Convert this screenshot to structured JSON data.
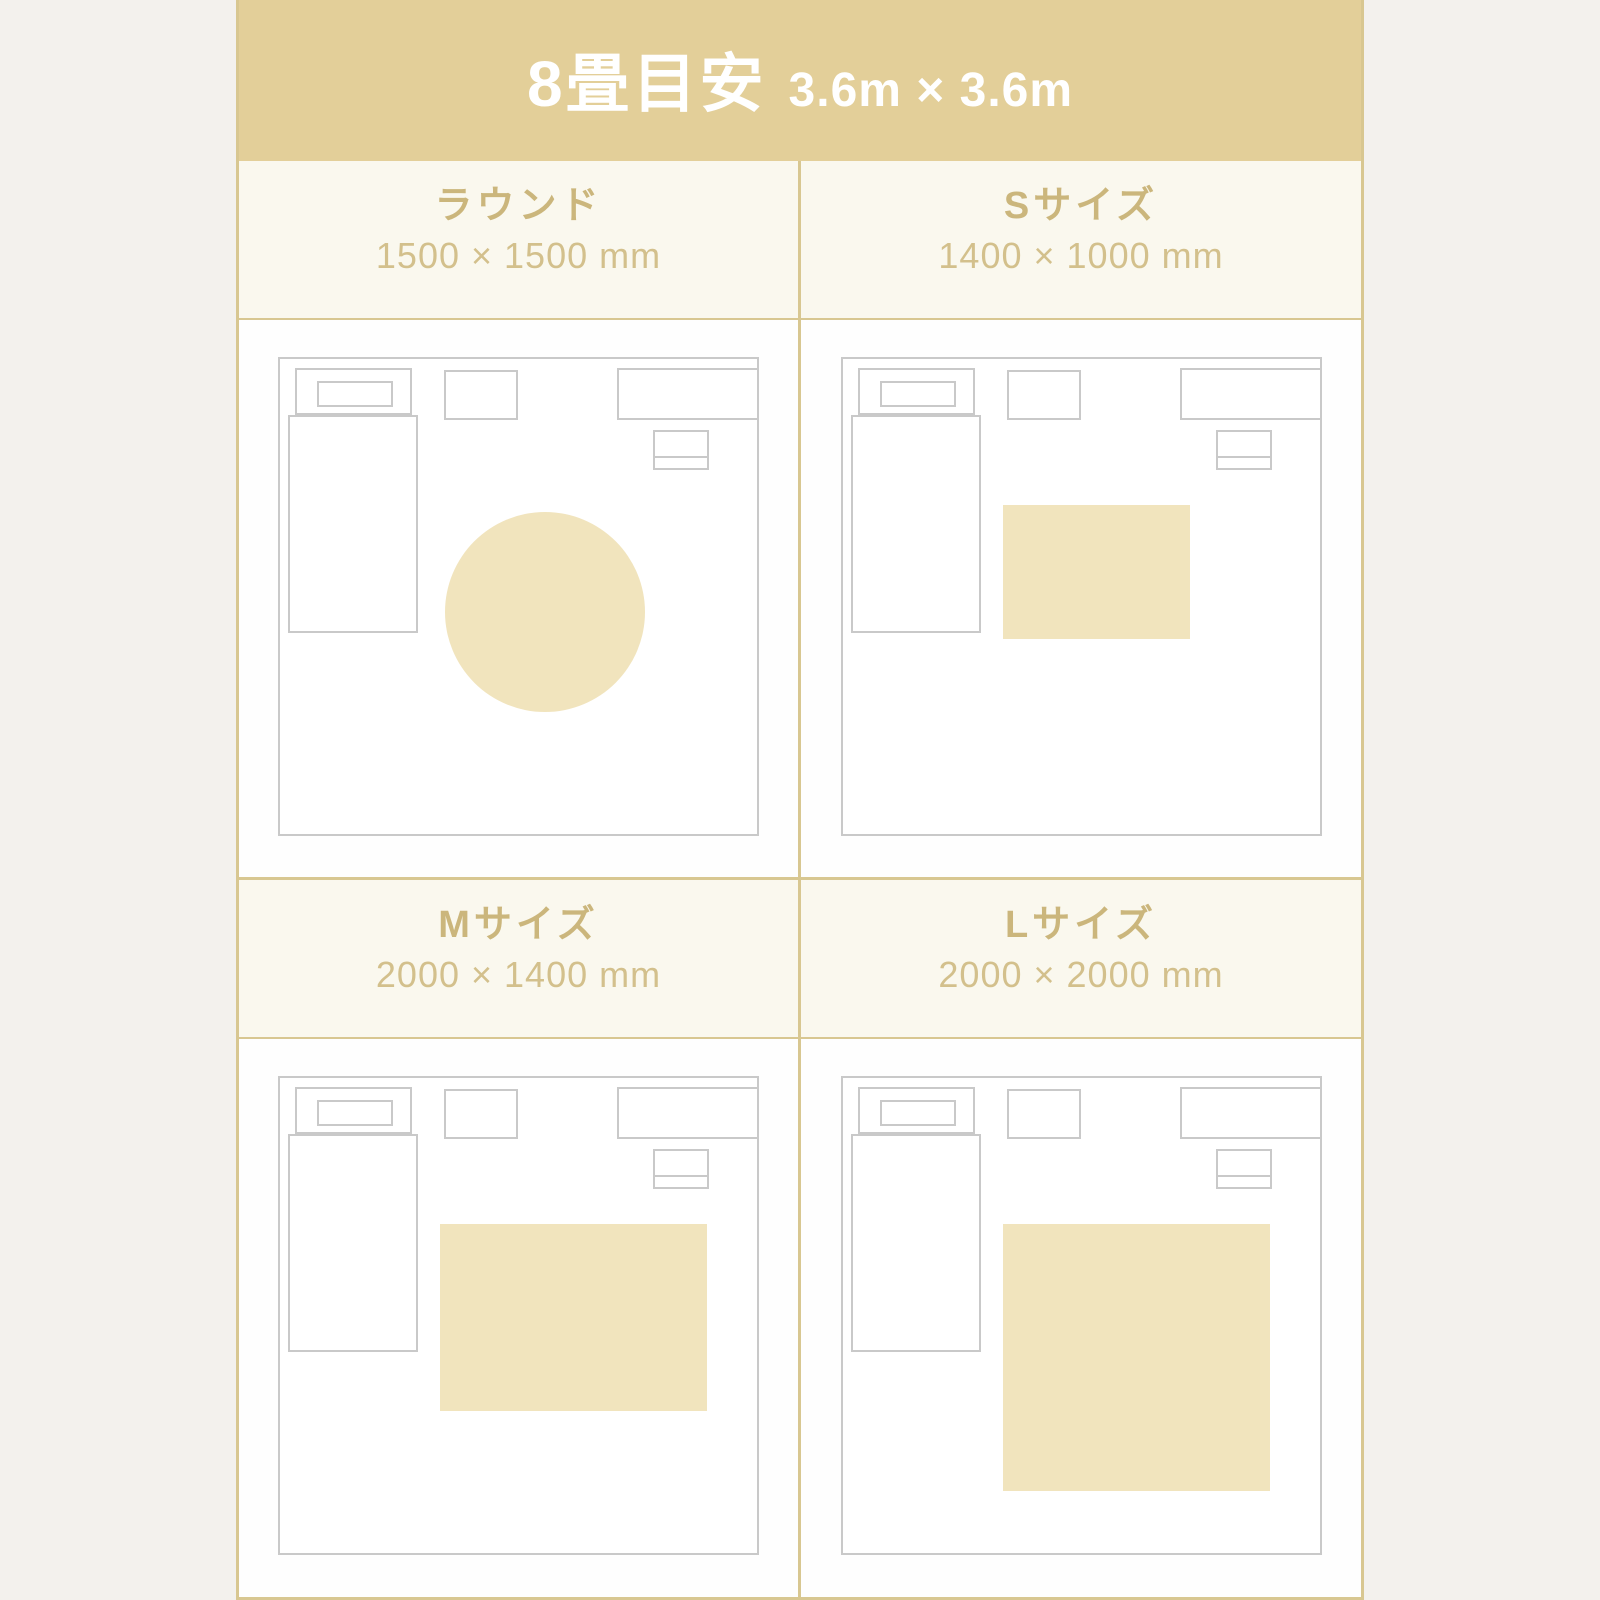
{
  "header": {
    "title": "8畳目安",
    "dimensions": "3.6m × 3.6m",
    "room_width_mm": 3600,
    "room_height_mm": 3600
  },
  "panels": [
    {
      "label": "ラウンド",
      "size_text": "1500 × 1500 mm",
      "rug": {
        "shape": "circle",
        "width_mm": 1500,
        "height_mm": 1500
      }
    },
    {
      "label": "Sサイズ",
      "size_text": "1400 × 1000 mm",
      "rug": {
        "shape": "rect",
        "width_mm": 1400,
        "height_mm": 1000
      }
    },
    {
      "label": "Mサイズ",
      "size_text": "2000 × 1400 mm",
      "rug": {
        "shape": "rect",
        "width_mm": 2000,
        "height_mm": 1400
      }
    },
    {
      "label": "Lサイズ",
      "size_text": "2000 × 2000 mm",
      "rug": {
        "shape": "rect",
        "width_mm": 2000,
        "height_mm": 2000
      }
    }
  ],
  "colors": {
    "band": "#e3cf99",
    "title_bg": "#faf8ee",
    "diagram_bg": "#fefefe",
    "line": "#d8c791",
    "page_bg": "#f3f1ed",
    "rug": "#f1e4bd",
    "outline": "#c9c9c9",
    "label_text": "#cbb67c",
    "size_text": "#d3c08c",
    "header_text": "#ffffff"
  }
}
